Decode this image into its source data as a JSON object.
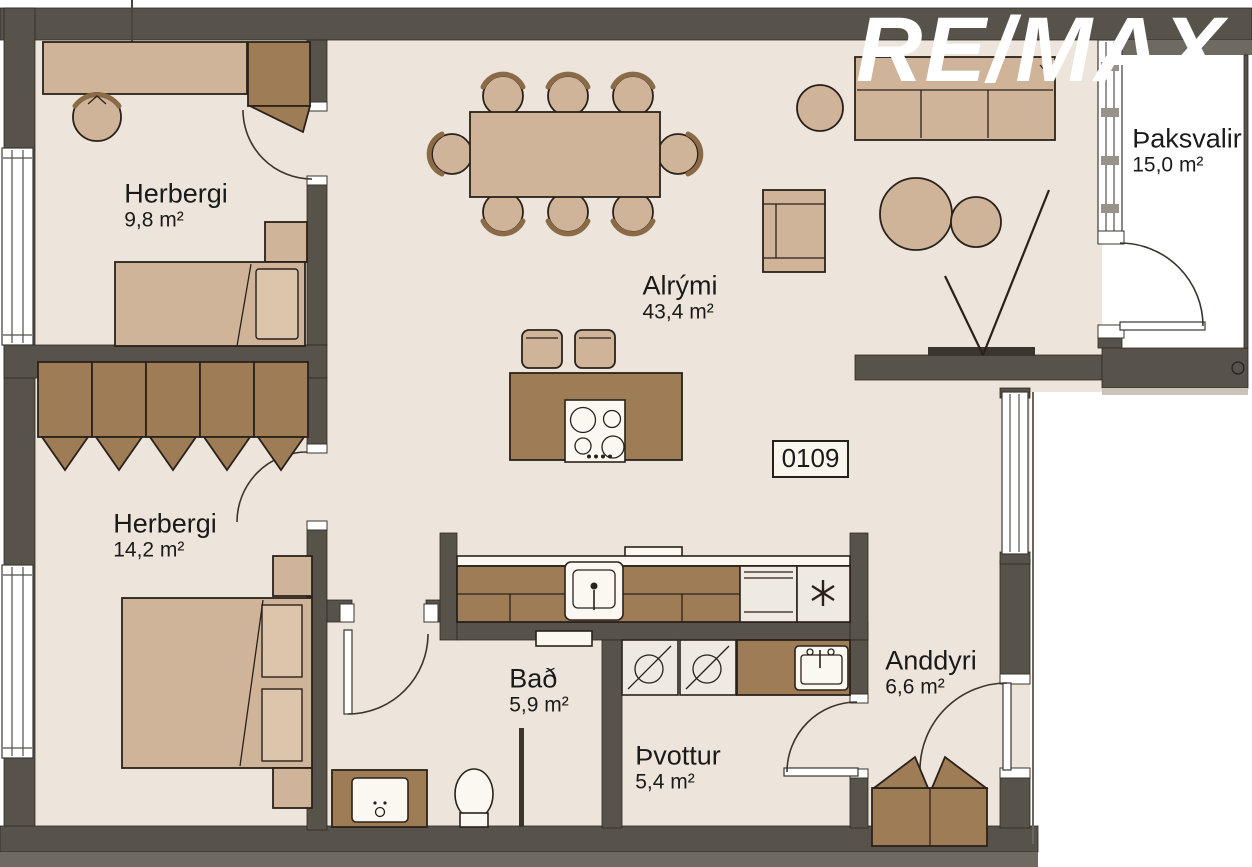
{
  "logo": {
    "text": "RE/MAX"
  },
  "unit_number": "0109",
  "rooms": [
    {
      "id": "herbergi-1",
      "name": "Herbergi",
      "area": "9,8 m²"
    },
    {
      "id": "herbergi-2",
      "name": "Herbergi",
      "area": "14,2 m²"
    },
    {
      "id": "alrymi",
      "name": "Alrými",
      "area": "43,4 m²"
    },
    {
      "id": "thaksvalir",
      "name": "Þaksvalir",
      "area": "15,0 m²"
    },
    {
      "id": "bad",
      "name": "Bað",
      "area": "5,9 m²"
    },
    {
      "id": "thvottur",
      "name": "Þvottur",
      "area": "5,4 m²"
    },
    {
      "id": "anddyri",
      "name": "Anddyri",
      "area": "6,6 m²"
    }
  ],
  "icons": {
    "freezer": "six-ray-snowflake-asterisk",
    "stove": "four-burner-cooktop",
    "washer": "circle-with-diagonal"
  },
  "colors": {
    "floor": "#EDE5DB",
    "wall_dark": "#57534A",
    "wall_light": "#6E6A62",
    "tan": "#CFB49A",
    "tan_light": "#DCC5AA",
    "brown": "#9E7C55",
    "outline": "#2A221A",
    "unit": "#EFEAE1",
    "text": "#1A1A1A"
  }
}
